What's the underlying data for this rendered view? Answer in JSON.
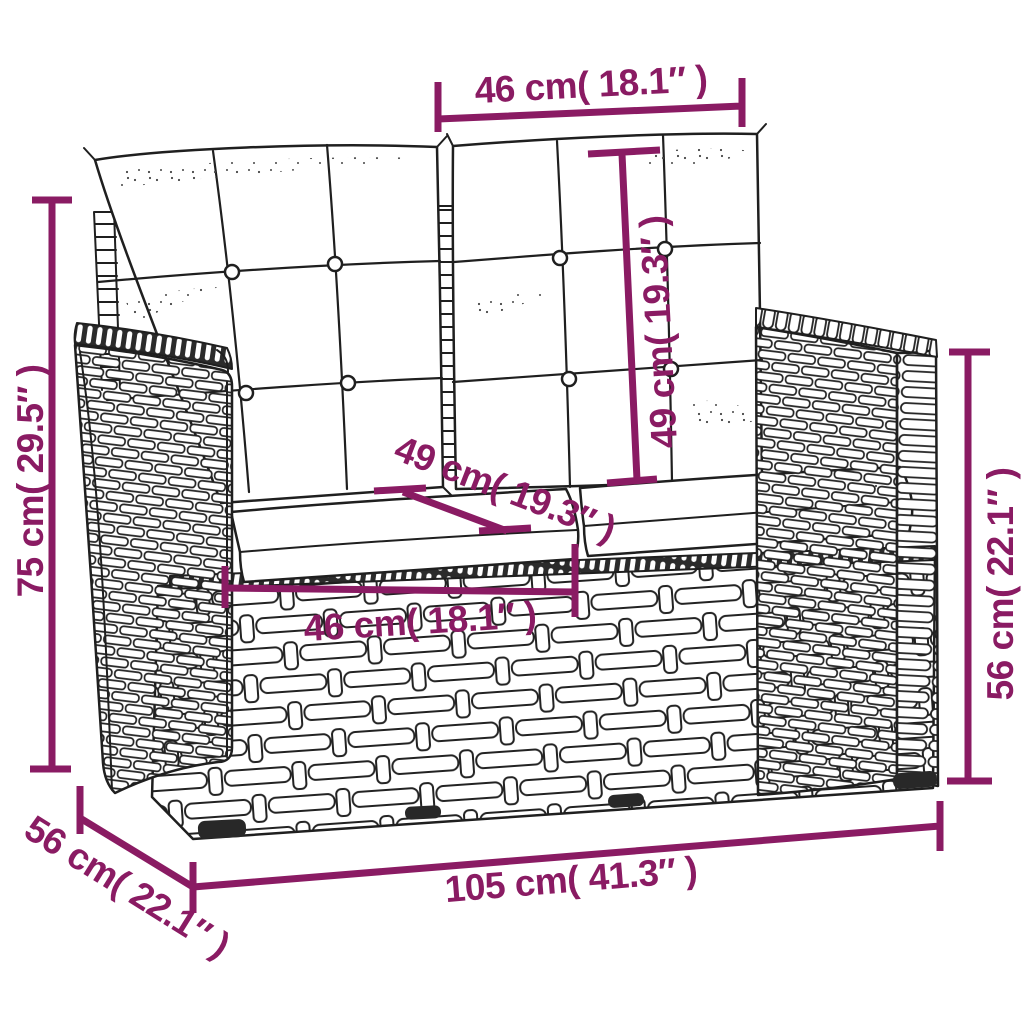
{
  "colors": {
    "dimension_accent": "#8a1b63",
    "line_art": "#1f1f1f",
    "background": "#ffffff",
    "cushion_fill": "#ffffff",
    "foot_fill": "#282828"
  },
  "dimensions": {
    "back_cushion_width": {
      "label": "46 cm( 18.1″ )"
    },
    "back_cushion_height": {
      "label": "49 cm( 19.3″ )"
    },
    "overall_height": {
      "label": "75 cm( 29.5″ )"
    },
    "seat_depth": {
      "label": "49 cm( 19.3″ )"
    },
    "seat_width": {
      "label": "46 cm( 18.1″ )"
    },
    "armrest_height": {
      "label": "56 cm( 22.1″ )"
    },
    "overall_depth": {
      "label": "56 cm( 22.1″ )"
    },
    "overall_width": {
      "label": "105 cm( 41.3″ )"
    }
  }
}
